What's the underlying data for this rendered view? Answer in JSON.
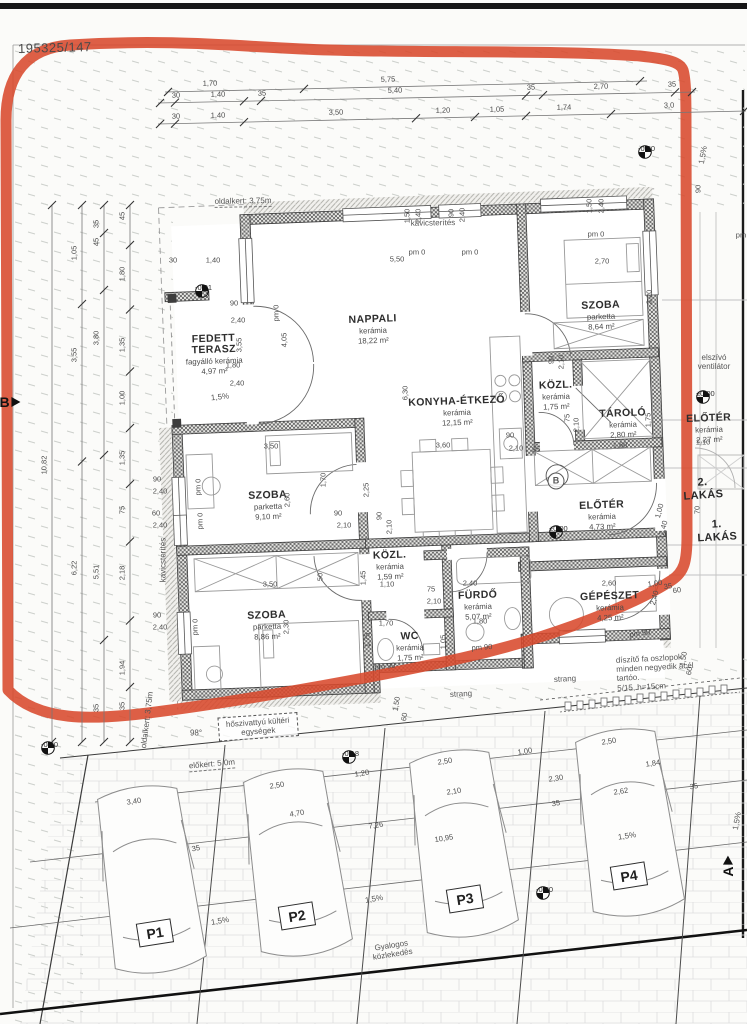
{
  "colors": {
    "annotation_red": "#d8492c",
    "wall": "#6f6f6f",
    "line": "#555555",
    "text": "#3c3c3c"
  },
  "parcel": {
    "number": "195325/147"
  },
  "rooms": [
    {
      "id": "fedett-terasz",
      "name": "FEDETT\nTERASZ",
      "material": "fagyálló kerámia",
      "area": "4,97 m²",
      "x": 214,
      "y": 355,
      "r": -2
    },
    {
      "id": "nappali",
      "name": "NAPPALI",
      "material": "kerámia",
      "area": "18,22 m²",
      "x": 373,
      "y": 330,
      "r": -2
    },
    {
      "id": "szoba-1",
      "name": "SZOBA",
      "material": "parketta",
      "area": "8,64 m²",
      "x": 601,
      "y": 316,
      "r": -2
    },
    {
      "id": "konyha-etkezo",
      "name": "KONYHA-ÉTKEZŐ",
      "material": "kerámia",
      "area": "12,15 m²",
      "x": 457,
      "y": 412,
      "r": -2
    },
    {
      "id": "kozl-1",
      "name": "KÖZL.",
      "material": "kerámia",
      "area": "1,75 m²",
      "x": 556,
      "y": 396,
      "r": -2
    },
    {
      "id": "tarolo",
      "name": "TÁROLÓ",
      "material": "kerámia",
      "area": "2,80 m²",
      "x": 623,
      "y": 424,
      "r": -2
    },
    {
      "id": "eloter-1",
      "name": "ELŐTÉR",
      "material": "kerámia",
      "area": "4,73 m²",
      "x": 602,
      "y": 516,
      "r": -2
    },
    {
      "id": "eloter-2",
      "name": "ELŐTÉR",
      "material": "kerámia",
      "area": "2,27 m²",
      "x": 709,
      "y": 429,
      "r": -2
    },
    {
      "id": "szoba-2",
      "name": "SZOBA",
      "material": "parketta",
      "area": "9,10 m²",
      "x": 268,
      "y": 506,
      "r": -2
    },
    {
      "id": "kozl-2",
      "name": "KÖZL.",
      "material": "kerámia",
      "area": "1,59 m²",
      "x": 390,
      "y": 566,
      "r": -2
    },
    {
      "id": "furdo",
      "name": "FÜRDŐ",
      "material": "kerámia",
      "area": "5,07 m²",
      "x": 478,
      "y": 606,
      "r": -2
    },
    {
      "id": "szoba-3",
      "name": "SZOBA",
      "material": "parketta",
      "area": "8,86 m²",
      "x": 267,
      "y": 626,
      "r": -2
    },
    {
      "id": "wc",
      "name": "WC",
      "material": "kerámia",
      "area": "1,75 m²",
      "x": 410,
      "y": 647,
      "r": -2
    },
    {
      "id": "gepeszet",
      "name": "GÉPÉSZET",
      "material": "kerámia",
      "area": "4,25 m²",
      "x": 610,
      "y": 607,
      "r": -2
    }
  ],
  "unit_labels": [
    {
      "t": "2. LAKÁS",
      "x": 703,
      "y": 489,
      "r": -4
    },
    {
      "t": "1. LAKÁS",
      "x": 717,
      "y": 531,
      "r": -3
    }
  ],
  "site_labels": [
    {
      "t": "oldalkert: 3,75m",
      "x": 243,
      "y": 202,
      "r": -1,
      "cls": "dash"
    },
    {
      "t": "kavicsterítés",
      "x": 433,
      "y": 223,
      "r": -1,
      "cls": ""
    },
    {
      "t": "kavicsterítés",
      "x": 163,
      "y": 560,
      "r": -90,
      "cls": ""
    },
    {
      "t": "oldalkert: 3,75m",
      "x": 147,
      "y": 720,
      "r": -83,
      "cls": ""
    },
    {
      "t": "elszívó\nventilátor",
      "x": 714,
      "y": 362,
      "r": 0,
      "cls": ""
    },
    {
      "t": "hőszivattyú kültéri\negységek",
      "x": 258,
      "y": 727,
      "r": -4,
      "cls": "box"
    },
    {
      "t": "előkert: 5,0m",
      "x": 212,
      "y": 765,
      "r": -5,
      "cls": "dash"
    },
    {
      "t": "Gyalogos\nközlekedés",
      "x": 392,
      "y": 950,
      "r": -9,
      "cls": ""
    },
    {
      "t": "strang",
      "x": 461,
      "y": 694,
      "r": -3,
      "cls": ""
    },
    {
      "t": "strang",
      "x": 565,
      "y": 679,
      "r": -3,
      "cls": ""
    },
    {
      "t": "díszítő fa oszlopok\nminden negyedik acél tartóo.\n5/15, h=15cm",
      "x": 660,
      "y": 672,
      "r": -3,
      "cls": "left"
    },
    {
      "t": "1,5%",
      "x": 220,
      "y": 397,
      "r": -6,
      "cls": ""
    },
    {
      "t": "1,5%",
      "x": 703,
      "y": 155,
      "r": -80,
      "cls": ""
    },
    {
      "t": "1,5%",
      "x": 220,
      "y": 921,
      "r": -10,
      "cls": ""
    },
    {
      "t": "1,5%",
      "x": 374,
      "y": 899,
      "r": -10,
      "cls": ""
    },
    {
      "t": "1,5%",
      "x": 627,
      "y": 836,
      "r": -9,
      "cls": ""
    },
    {
      "t": "1,5%",
      "x": 737,
      "y": 821,
      "r": -80,
      "cls": ""
    },
    {
      "t": "98°",
      "x": 196,
      "y": 733,
      "r": 0,
      "cls": ""
    },
    {
      "t": "B",
      "x": 556,
      "y": 481,
      "r": 0,
      "cls": "circleB"
    }
  ],
  "level_markers": [
    {
      "v": "-0,01",
      "x": 202,
      "y": 291
    },
    {
      "v": "-0,20",
      "x": 645,
      "y": 152
    },
    {
      "v": "±0,00",
      "x": 556,
      "y": 532
    },
    {
      "v": "±0,00",
      "x": 703,
      "y": 397
    },
    {
      "v": "-0,20",
      "x": 48,
      "y": 748
    },
    {
      "v": "-0,18",
      "x": 349,
      "y": 757
    },
    {
      "v": "-0,20",
      "x": 543,
      "y": 893
    }
  ],
  "parking": {
    "labels": [
      {
        "t": "P1",
        "x": 155,
        "y": 933,
        "r": -9
      },
      {
        "t": "P2",
        "x": 297,
        "y": 916,
        "r": -9
      },
      {
        "t": "P3",
        "x": 465,
        "y": 899,
        "r": -9
      },
      {
        "t": "P4",
        "x": 629,
        "y": 876,
        "r": -9
      }
    ]
  },
  "section_markers": [
    {
      "t": "B",
      "x": 10,
      "y": 402,
      "r": 0
    },
    {
      "t": "A",
      "x": 728,
      "y": 866,
      "r": -90
    }
  ],
  "dim_chains": {
    "top": [
      {
        "x1": 165,
        "y1": 92,
        "x2": 647,
        "y2": 81,
        "labels": [
          {
            "t": "1,70",
            "x": 210
          },
          {
            "t": "5,75",
            "x": 388
          }
        ],
        "ticks": [
          168,
          304,
          640
        ]
      },
      {
        "x1": 158,
        "y1": 103,
        "x2": 695,
        "y2": 92,
        "labels": [
          {
            "t": "30",
            "x": 176
          },
          {
            "t": "1,40",
            "x": 218
          },
          {
            "t": "35",
            "x": 262
          },
          {
            "t": "5,40",
            "x": 395
          },
          {
            "t": "35",
            "x": 531
          },
          {
            "t": "2,70",
            "x": 601
          },
          {
            "t": "35",
            "x": 672
          }
        ],
        "ticks": [
          160,
          175,
          244,
          261,
          526,
          543,
          675,
          692
        ]
      },
      {
        "x1": 158,
        "y1": 124,
        "x2": 746,
        "y2": 111,
        "labels": [
          {
            "t": "30",
            "x": 176
          },
          {
            "t": "1,40",
            "x": 218
          },
          {
            "t": "3,50",
            "x": 336
          },
          {
            "t": "1,20",
            "x": 443
          },
          {
            "t": "1,05",
            "x": 497
          },
          {
            "t": "1,74",
            "x": 564
          },
          {
            "t": "3,0",
            "x": 669
          }
        ],
        "ticks": [
          160,
          175,
          244,
          416,
          475,
          526,
          611,
          744
        ]
      }
    ],
    "left": [
      {
        "x": 52,
        "y1": 205,
        "y2": 742,
        "labels": [
          {
            "t": "10,82",
            "y": 465
          }
        ]
      },
      {
        "x": 82,
        "y1": 205,
        "y2": 742,
        "labels": [
          {
            "t": "1,05",
            "y": 253
          },
          {
            "t": "3,55",
            "y": 355
          },
          {
            "t": "6,22",
            "y": 568
          }
        ]
      },
      {
        "x": 104,
        "y1": 205,
        "y2": 742,
        "labels": [
          {
            "t": "35",
            "y": 224
          },
          {
            "t": "45",
            "y": 242
          },
          {
            "t": "3,80",
            "y": 338
          },
          {
            "t": "5,51",
            "y": 572
          },
          {
            "t": "35",
            "y": 708
          }
        ]
      },
      {
        "x": 130,
        "y1": 205,
        "y2": 742,
        "labels": [
          {
            "t": "45",
            "y": 216
          },
          {
            "t": "1,80",
            "y": 274
          },
          {
            "t": "1,35",
            "y": 345
          },
          {
            "t": "1,00",
            "y": 398
          },
          {
            "t": "1,35",
            "y": 458
          },
          {
            "t": "75",
            "y": 510
          },
          {
            "t": "2,18",
            "y": 573
          },
          {
            "t": "1,94",
            "y": 668
          },
          {
            "t": "35",
            "y": 706
          }
        ]
      }
    ]
  },
  "small_dims": [
    {
      "t": "1,50",
      "x": 408,
      "y": 216,
      "r": -90
    },
    {
      "t": "2,40",
      "x": 419,
      "y": 216,
      "r": -90
    },
    {
      "t": "90",
      "x": 452,
      "y": 213,
      "r": -90
    },
    {
      "t": "2,40",
      "x": 463,
      "y": 215,
      "r": -90
    },
    {
      "t": "1,50",
      "x": 590,
      "y": 206,
      "r": -90
    },
    {
      "t": "2,40",
      "x": 602,
      "y": 206,
      "r": -90
    },
    {
      "t": "90",
      "x": 699,
      "y": 189,
      "r": -90
    },
    {
      "t": "5,50",
      "x": 397,
      "y": 260
    },
    {
      "t": "2,70",
      "x": 602,
      "y": 262
    },
    {
      "t": "3,20",
      "x": 650,
      "y": 297,
      "r": -90
    },
    {
      "t": "4,05",
      "x": 285,
      "y": 340,
      "r": -90
    },
    {
      "t": "3,55",
      "x": 240,
      "y": 345,
      "r": -90
    },
    {
      "t": "pm 0",
      "x": 417,
      "y": 253
    },
    {
      "t": "pm 0",
      "x": 470,
      "y": 253
    },
    {
      "t": "pm 0",
      "x": 596,
      "y": 235
    },
    {
      "t": "pm",
      "x": 741,
      "y": 236
    },
    {
      "t": "pm 0",
      "x": 277,
      "y": 313,
      "r": -90
    },
    {
      "t": "pm 0",
      "x": 199,
      "y": 487,
      "r": -90
    },
    {
      "t": "pm 0",
      "x": 201,
      "y": 521,
      "r": -90
    },
    {
      "t": "pm 0",
      "x": 196,
      "y": 627,
      "r": -90
    },
    {
      "t": "30",
      "x": 173,
      "y": 261
    },
    {
      "t": "1,40",
      "x": 213,
      "y": 261
    },
    {
      "t": "90",
      "x": 234,
      "y": 304
    },
    {
      "t": "2,40",
      "x": 238,
      "y": 321
    },
    {
      "t": "1,80",
      "x": 233,
      "y": 366
    },
    {
      "t": "2,40",
      "x": 237,
      "y": 384
    },
    {
      "t": "90",
      "x": 157,
      "y": 480
    },
    {
      "t": "2,40",
      "x": 160,
      "y": 492
    },
    {
      "t": "60",
      "x": 156,
      "y": 514
    },
    {
      "t": "2,40",
      "x": 160,
      "y": 526
    },
    {
      "t": "90",
      "x": 157,
      "y": 616
    },
    {
      "t": "2,40",
      "x": 160,
      "y": 628
    },
    {
      "t": "3,50",
      "x": 271,
      "y": 447
    },
    {
      "t": "1,70",
      "x": 324,
      "y": 480,
      "r": -90
    },
    {
      "t": "2,60",
      "x": 288,
      "y": 500,
      "r": -90
    },
    {
      "t": "2,25",
      "x": 367,
      "y": 490,
      "r": -90
    },
    {
      "t": "90",
      "x": 338,
      "y": 514
    },
    {
      "t": "2,10",
      "x": 344,
      "y": 526
    },
    {
      "t": "90",
      "x": 380,
      "y": 516,
      "r": -90
    },
    {
      "t": "2,10",
      "x": 390,
      "y": 527,
      "r": -90
    },
    {
      "t": "3,60",
      "x": 443,
      "y": 446
    },
    {
      "t": "6,30",
      "x": 406,
      "y": 393,
      "r": -90
    },
    {
      "t": "90",
      "x": 510,
      "y": 436
    },
    {
      "t": "2,10",
      "x": 516,
      "y": 449
    },
    {
      "t": "25",
      "x": 536,
      "y": 450
    },
    {
      "t": "75",
      "x": 568,
      "y": 418,
      "r": -90
    },
    {
      "t": "2,10",
      "x": 577,
      "y": 425,
      "r": -90
    },
    {
      "t": "90",
      "x": 552,
      "y": 360,
      "r": -90
    },
    {
      "t": "2,10",
      "x": 562,
      "y": 362,
      "r": -90
    },
    {
      "t": "1,75",
      "x": 649,
      "y": 420,
      "r": -90
    },
    {
      "t": "1,60",
      "x": 620,
      "y": 446
    },
    {
      "t": "1,00",
      "x": 660,
      "y": 511,
      "r": -75
    },
    {
      "t": "2,40",
      "x": 664,
      "y": 528,
      "r": -75
    },
    {
      "t": "70",
      "x": 698,
      "y": 510,
      "r": -90
    },
    {
      "t": "1,10",
      "x": 703,
      "y": 443
    },
    {
      "t": "3,50",
      "x": 270,
      "y": 585
    },
    {
      "t": "2,30",
      "x": 287,
      "y": 627,
      "r": -90
    },
    {
      "t": "1,45",
      "x": 364,
      "y": 578,
      "r": -90
    },
    {
      "t": "1,10",
      "x": 387,
      "y": 585
    },
    {
      "t": "50",
      "x": 321,
      "y": 577,
      "r": -90
    },
    {
      "t": "1,75",
      "x": 368,
      "y": 640,
      "r": -90
    },
    {
      "t": "1,05",
      "x": 444,
      "y": 642,
      "r": -90
    },
    {
      "t": "1,70",
      "x": 386,
      "y": 624
    },
    {
      "t": "75",
      "x": 431,
      "y": 590
    },
    {
      "t": "2,10",
      "x": 434,
      "y": 602
    },
    {
      "t": "2,40",
      "x": 470,
      "y": 584
    },
    {
      "t": "1,80",
      "x": 480,
      "y": 622
    },
    {
      "t": "2,60",
      "x": 609,
      "y": 584
    },
    {
      "t": "2,40",
      "x": 655,
      "y": 598,
      "r": -75
    },
    {
      "t": "1,00",
      "x": 655,
      "y": 584,
      "r": -8
    },
    {
      "t": "35",
      "x": 668,
      "y": 587,
      "r": -8
    },
    {
      "t": "60",
      "x": 677,
      "y": 591,
      "r": -8
    },
    {
      "t": "pm 90",
      "x": 482,
      "y": 648,
      "r": -4
    },
    {
      "t": "pm 90",
      "x": 385,
      "y": 667,
      "r": -6
    },
    {
      "t": "pm 90",
      "x": 640,
      "y": 634,
      "r": -8
    },
    {
      "t": "1,50",
      "x": 397,
      "y": 704,
      "r": -80
    },
    {
      "t": "60",
      "x": 405,
      "y": 717,
      "r": -80
    },
    {
      "t": "1,50",
      "x": 684,
      "y": 659,
      "r": -80
    },
    {
      "t": "60",
      "x": 690,
      "y": 671,
      "r": -80
    },
    {
      "t": "3,40",
      "x": 134,
      "y": 802,
      "r": -9
    },
    {
      "t": "2,50",
      "x": 277,
      "y": 786,
      "r": -9
    },
    {
      "t": "4,70",
      "x": 297,
      "y": 814,
      "r": -9
    },
    {
      "t": "7,26",
      "x": 376,
      "y": 826,
      "r": -9
    },
    {
      "t": "10,95",
      "x": 444,
      "y": 839,
      "r": -9
    },
    {
      "t": "1,20",
      "x": 362,
      "y": 774,
      "r": -9
    },
    {
      "t": "2,50",
      "x": 445,
      "y": 762,
      "r": -9
    },
    {
      "t": "2,50",
      "x": 609,
      "y": 742,
      "r": -9
    },
    {
      "t": "1,00",
      "x": 525,
      "y": 752,
      "r": -9
    },
    {
      "t": "2,30",
      "x": 556,
      "y": 779,
      "r": -9
    },
    {
      "t": "2,10",
      "x": 454,
      "y": 792,
      "r": -9
    },
    {
      "t": "2,62",
      "x": 621,
      "y": 792,
      "r": -9
    },
    {
      "t": "35",
      "x": 556,
      "y": 804,
      "r": -9
    },
    {
      "t": "1,84",
      "x": 653,
      "y": 764,
      "r": -9
    },
    {
      "t": "35",
      "x": 694,
      "y": 787,
      "r": -9
    },
    {
      "t": "35",
      "x": 196,
      "y": 849,
      "r": -9
    }
  ]
}
